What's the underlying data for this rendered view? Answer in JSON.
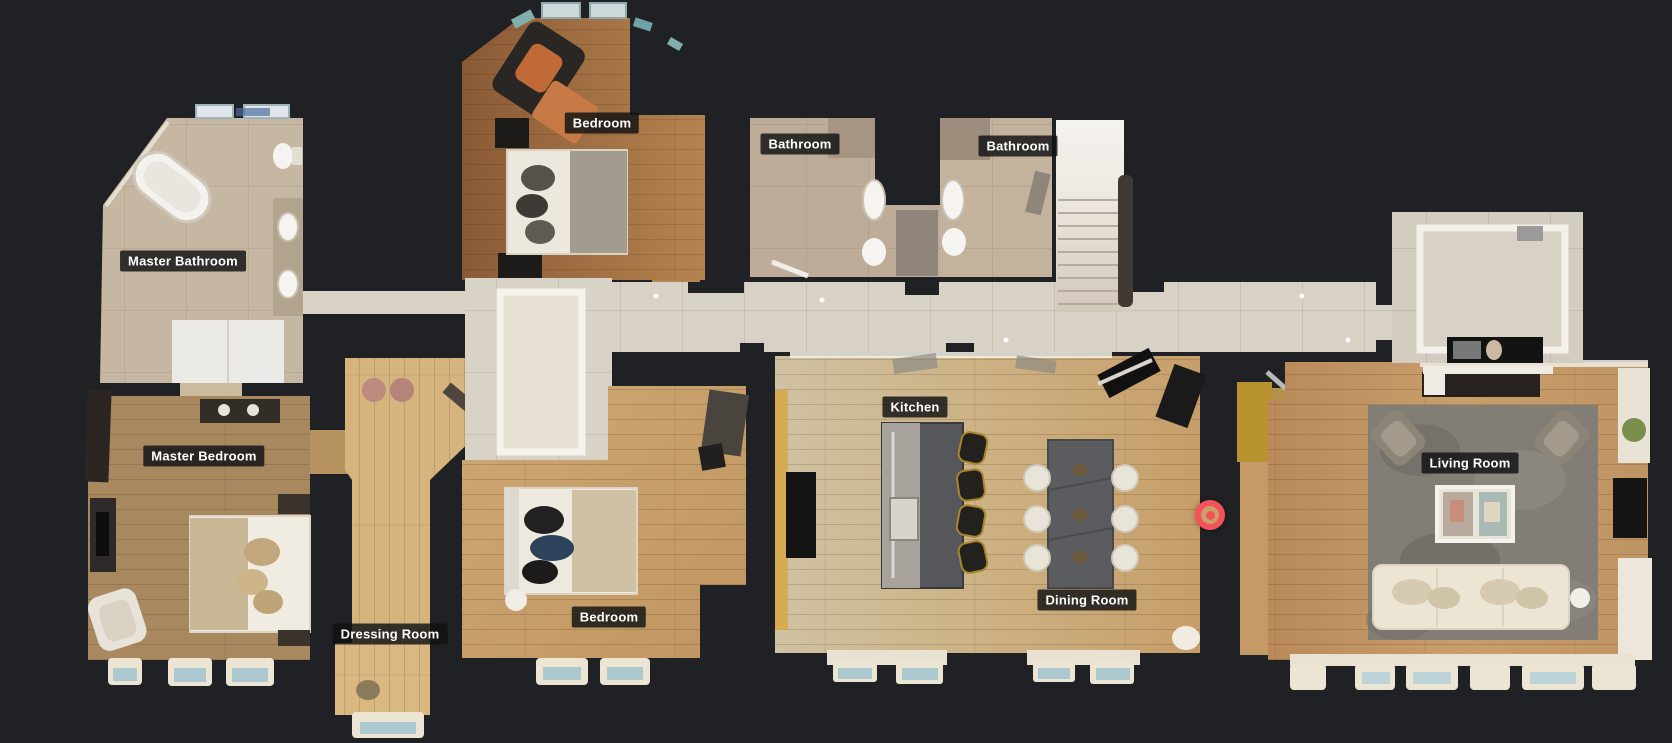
{
  "app": {
    "view": "floorplan-top-down-view",
    "background_color": "#1f2124"
  },
  "rooms": [
    {
      "id": "master-bathroom",
      "label": "Master Bathroom",
      "x": 183,
      "y": 261
    },
    {
      "id": "master-bedroom",
      "label": "Master Bedroom",
      "x": 204,
      "y": 456
    },
    {
      "id": "dressing-room",
      "label": "Dressing Room",
      "x": 390,
      "y": 634
    },
    {
      "id": "bedroom-1",
      "label": "Bedroom",
      "x": 602,
      "y": 123
    },
    {
      "id": "bedroom-2",
      "label": "Bedroom",
      "x": 609,
      "y": 617
    },
    {
      "id": "bathroom-1",
      "label": "Bathroom",
      "x": 800,
      "y": 144
    },
    {
      "id": "bathroom-2",
      "label": "Bathroom",
      "x": 1018,
      "y": 146
    },
    {
      "id": "kitchen",
      "label": "Kitchen",
      "x": 915,
      "y": 407
    },
    {
      "id": "dining-room",
      "label": "Dining Room",
      "x": 1087,
      "y": 600
    },
    {
      "id": "living-room",
      "label": "Living Room",
      "x": 1470,
      "y": 463
    }
  ],
  "marker": {
    "name": "current-position",
    "x": 1210,
    "y": 515,
    "ring_color": "#f3525a",
    "center_color": "#f3525a"
  },
  "label_style": {
    "background": "rgba(16,17,18,0.82)",
    "text_color": "#ffffff"
  }
}
